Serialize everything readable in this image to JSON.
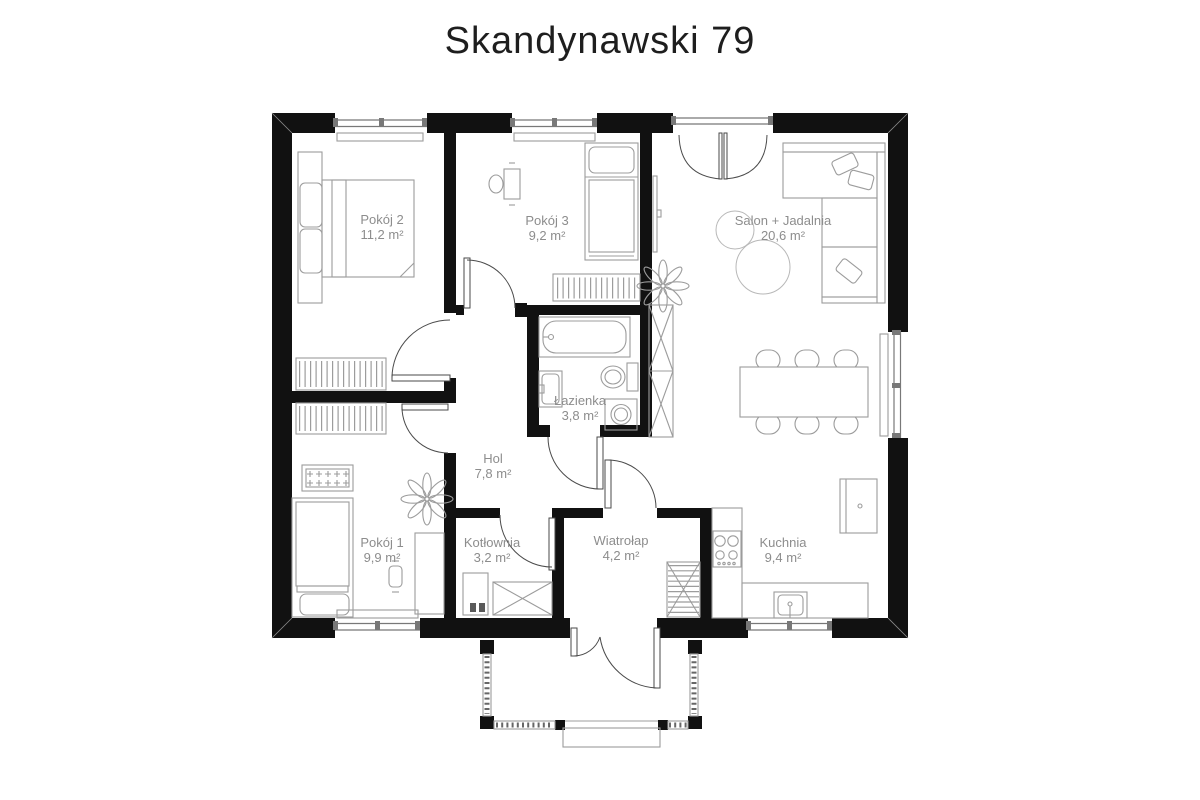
{
  "title": "Skandynawski 79",
  "rooms": [
    {
      "id": "pokoj2",
      "name": "Pokój 2",
      "area": "11,2 m²"
    },
    {
      "id": "pokoj3",
      "name": "Pokój 3",
      "area": "9,2 m²"
    },
    {
      "id": "salon",
      "name": "Salon + Jadalnia",
      "area": "20,6 m²"
    },
    {
      "id": "lazienka",
      "name": "Łazienka",
      "area": "3,8 m²"
    },
    {
      "id": "hol",
      "name": "Hol",
      "area": "7,8 m²"
    },
    {
      "id": "pokoj1",
      "name": "Pokój 1",
      "area": "9,9 m²"
    },
    {
      "id": "kotlownia",
      "name": "Kotłownia",
      "area": "3,2 m²"
    },
    {
      "id": "wiatrolap",
      "name": "Wiatrołap",
      "area": "4,2 m²"
    },
    {
      "id": "kuchnia",
      "name": "Kuchnia",
      "area": "9,4 m²"
    }
  ],
  "colors": {
    "walls": "#111111",
    "furniture_line": "#9c9c9c",
    "label_text": "#8d8d8d",
    "title_text": "#1e1e1e",
    "background": "#ffffff"
  }
}
